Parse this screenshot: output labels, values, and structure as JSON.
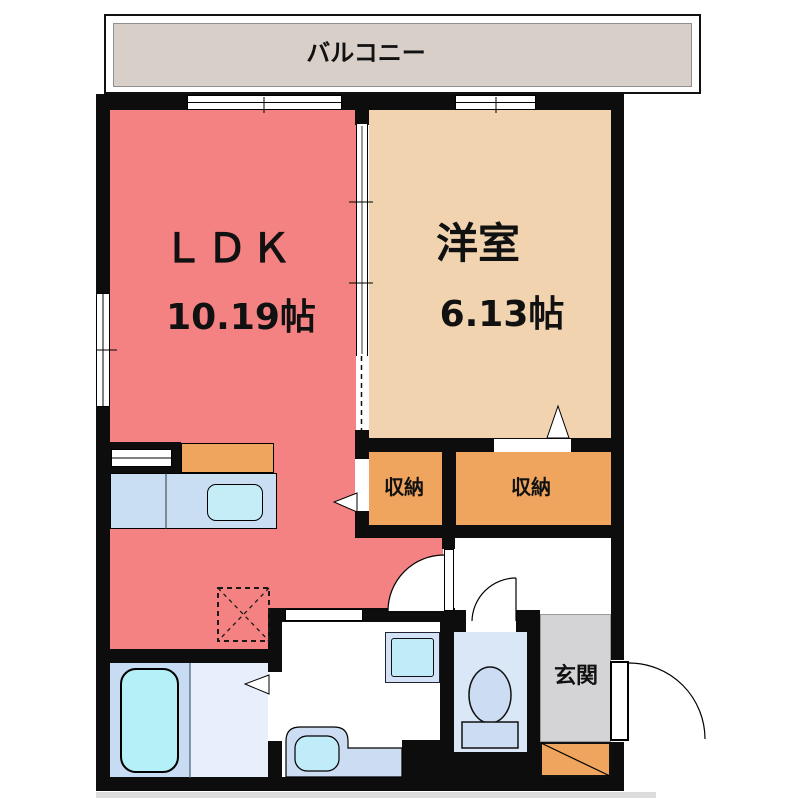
{
  "plan": {
    "balcony": {
      "label": "バルコニー"
    },
    "ldk": {
      "label": "ＬＤＫ",
      "size": "10.19帖"
    },
    "western_room": {
      "label": "洋室",
      "size": "6.13帖"
    },
    "storage_left": {
      "label": "収納"
    },
    "storage_right": {
      "label": "収納"
    },
    "entrance": {
      "label": "玄関"
    }
  },
  "colors": {
    "wall": "#0d0d0d",
    "ldk": "#f48282",
    "western": "#f1d3af",
    "storage": "#f0a55f",
    "balcony": "#d8cfc9",
    "genkan": "#d4d4d6",
    "shoebox": "#f0a55f",
    "bath-a": "#c7dbf3",
    "bath-b": "#e6effb",
    "tub": "#b5eff8",
    "counter": "#c9ddf3",
    "sink": "#c4edf8",
    "toilet-floor": "#d9e7f7",
    "fixture-blue": "#ccdcf2",
    "pan-outer": "#d3e2f6",
    "pan-inner": "#c0ebf8"
  }
}
